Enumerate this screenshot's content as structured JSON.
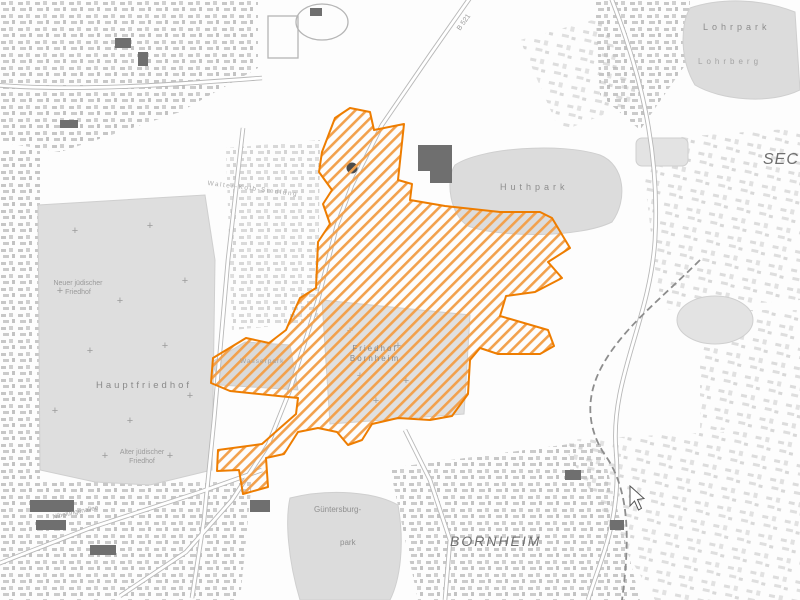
{
  "map": {
    "region_labels": {
      "lohrpark": "Lohrpark",
      "lohrberg": "Lohrberg",
      "huthpark": "Huthpark",
      "seckbach_partial": "SEC",
      "hauptfriedhof": "Hauptfriedhof",
      "neuer_juedischer_friedhof_line1": "Neuer jüdischer",
      "neuer_juedischer_friedhof_line2": "Friedhof",
      "alter_juedischer_friedhof_line1": "Alter jüdischer",
      "alter_juedischer_friedhof_line2": "Friedhof",
      "friedhof_bornheim_line1": "Friedhof",
      "friedhof_bornheim_line2": "Bornheim",
      "wasserpark": "Wasserpark",
      "guentersburgpark_line1": "Güntersburg-",
      "guentersburgpark_line2": "park",
      "bornheim": "BORNHEIM",
      "walter_kolb_siedlung": "Walter-Kolb-Siedlung",
      "nibelungenallee": "Nibelungenallee",
      "road_b521": "B 521"
    },
    "overlay": {
      "description": "hatched highlighted planning area",
      "stroke_color": "#ee7d00",
      "hatch_color": "#f2a14d"
    },
    "colors": {
      "park_fill": "#dcdcdc",
      "building_gray": "#6f6f6f",
      "road_gray": "#b8b8b8"
    }
  }
}
